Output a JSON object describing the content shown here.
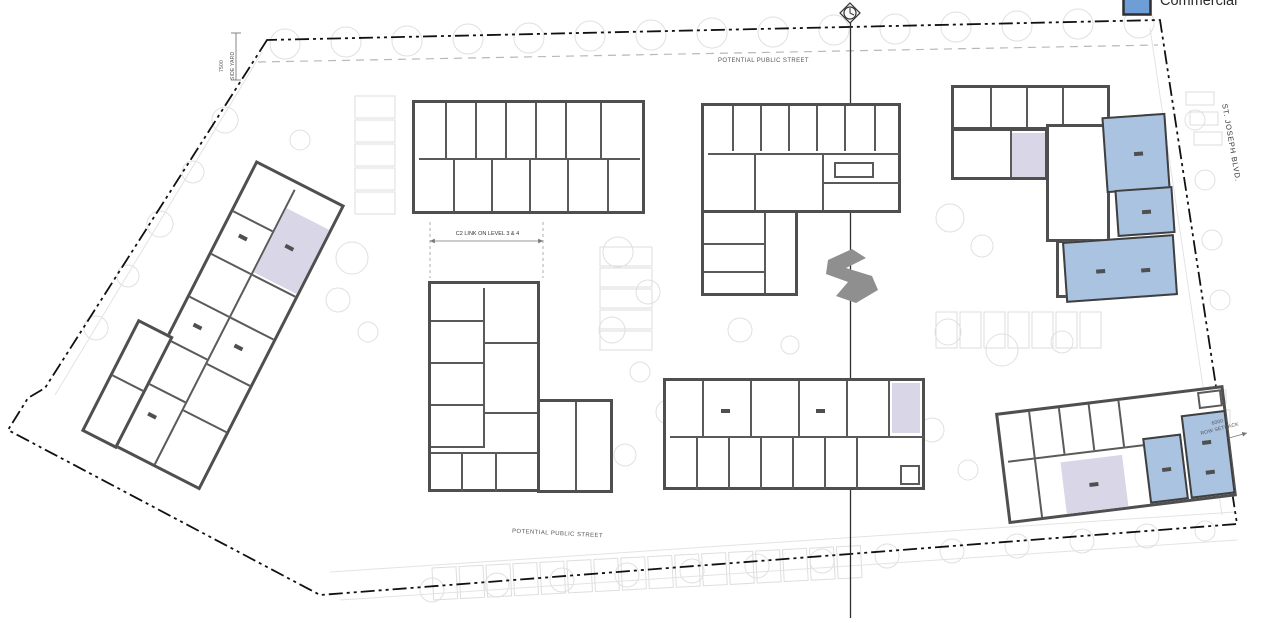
{
  "legend": {
    "items": [
      {
        "label": "Commercial",
        "swatch_color": "#6f9ed6"
      }
    ]
  },
  "labels": {
    "street_top": "POTENTIAL PUBLIC STREET",
    "street_bottom": "POTENTIAL PUBLIC STREET",
    "c2_link": "C2 LINK ON LEVEL 3 & 4",
    "side_yard_dim": "7500",
    "side_yard": "SIDE YARD",
    "st_joseph_blvd": "ST. JOSEPH BLVD.",
    "setback_dim": "6000",
    "setback": "ROW SETBACK"
  },
  "colors": {
    "commercial_fill": "#aac3e1",
    "amenity_fill": "#d9d6e8",
    "wall": "#4f4f4f",
    "boundary": "#111111"
  }
}
